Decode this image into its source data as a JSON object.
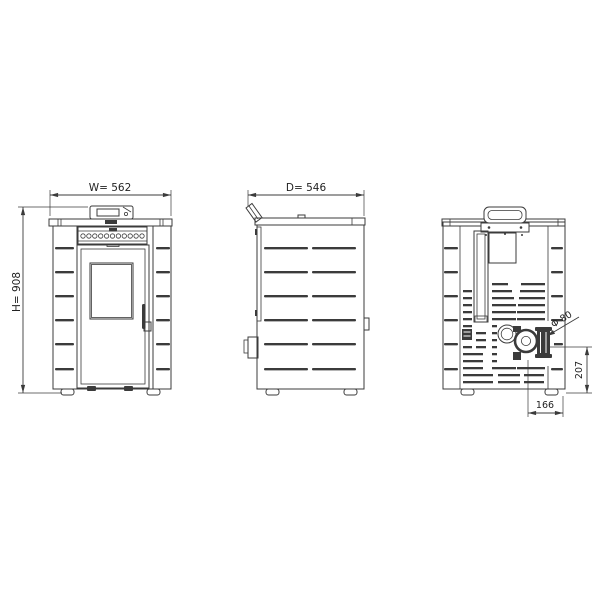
{
  "drawing": {
    "background": "#ffffff",
    "line_color": "#3b3b3b",
    "text_color": "#222222",
    "dimensions": {
      "front_width": "W= 562",
      "front_height": "H= 908",
      "side_depth": "D= 546",
      "flue_diameter": "Φ 80",
      "flue_center_height": "207",
      "flue_center_offset": "166"
    }
  }
}
